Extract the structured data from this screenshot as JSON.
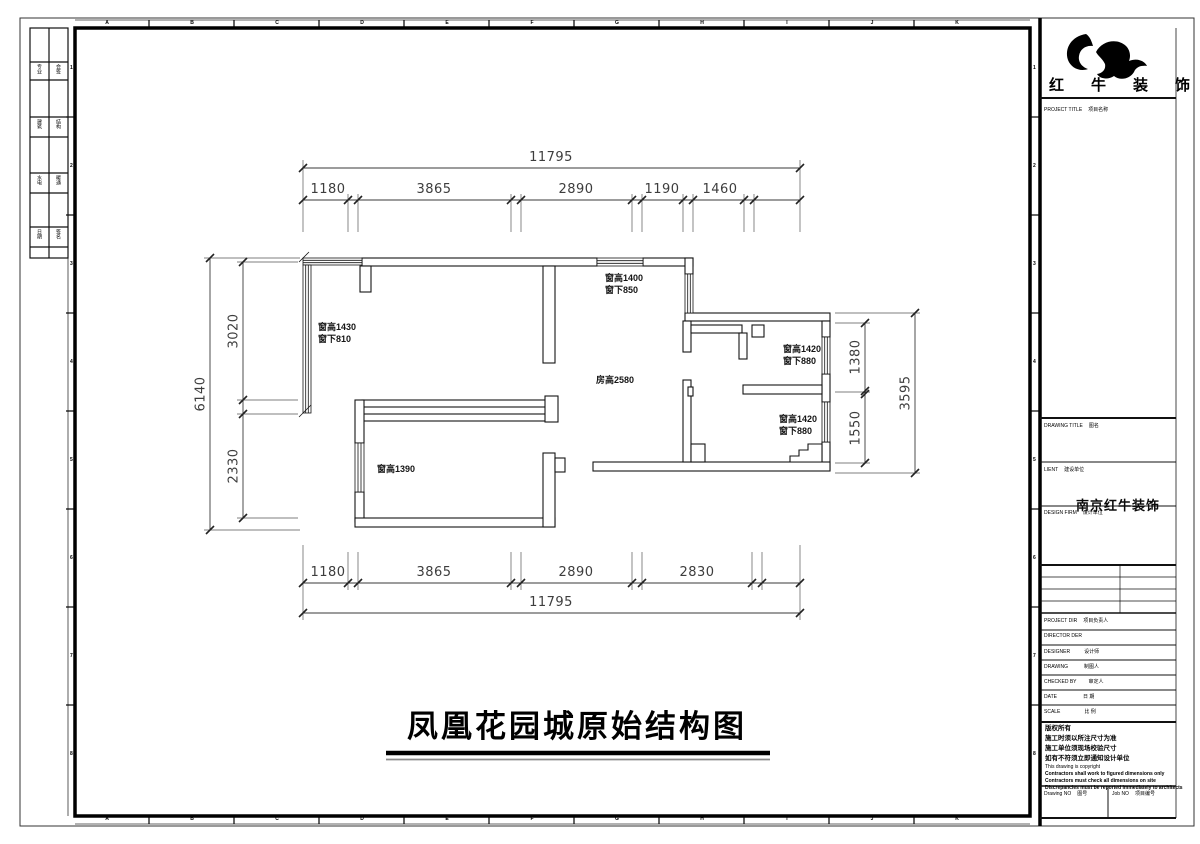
{
  "sheet": {
    "main_title": "凤凰花园城原始结构图",
    "grid_letters": [
      "A",
      "B",
      "C",
      "D",
      "E",
      "F",
      "G",
      "H",
      "I",
      "J",
      "K"
    ],
    "grid_numbers": [
      "1",
      "2",
      "3",
      "4",
      "5",
      "6",
      "7",
      "8"
    ]
  },
  "signature_bar": {
    "rows": [
      [
        "专业",
        "会签"
      ],
      [
        "建筑",
        "结构"
      ],
      [
        "水电",
        "暖通"
      ],
      [
        "日期",
        "签名"
      ]
    ]
  },
  "plan": {
    "labels": {
      "win_left_top": {
        "l1": "窗高1430",
        "l2": "窗下810"
      },
      "win_top": {
        "l1": "窗高1400",
        "l2": "窗下850"
      },
      "win_right_1": {
        "l1": "窗高1420",
        "l2": "窗下880"
      },
      "win_right_2": {
        "l1": "窗高1420",
        "l2": "窗下880"
      },
      "win_left_bottom": "窗高1390",
      "room_height": "房高2580"
    },
    "dims": {
      "top_total": "11795",
      "top_segs": [
        "1180",
        "3865",
        "2890",
        "1190",
        "1460"
      ],
      "bottom_segs": [
        "1180",
        "3865",
        "2890",
        "2830"
      ],
      "bottom_total": "11795",
      "left_total": "6140",
      "left_segs": [
        "3020",
        "2330"
      ],
      "right_segs": [
        "1380",
        "1550"
      ],
      "right_total": "3595"
    }
  },
  "tb": {
    "company": "红牛装饰",
    "project_title": {
      "en": "PROJECT TITLE",
      "zh": "项目名称"
    },
    "drawing_title": {
      "en": "DRAWING TITLE",
      "zh": "图名"
    },
    "client": {
      "en": "LIENT",
      "zh": "建设单位"
    },
    "design_firm": {
      "en": "DESIGN FIRM",
      "zh": "设计单位"
    },
    "stamp": "南京红牛装饰",
    "project_dir": {
      "en": "PROJECT DIR",
      "zh": "项目负责人"
    },
    "director": {
      "en": "DIRECTOR DER",
      "zh": ""
    },
    "designer": {
      "en": "DESIGNER",
      "zh": "设计师"
    },
    "drawing": {
      "en": "DRAWING",
      "zh": "制图人"
    },
    "checked": {
      "en": "CHECKED BY",
      "zh": "审定人"
    },
    "date": {
      "en": "DATE",
      "zh": "日 期"
    },
    "scale": {
      "en": "SCALE",
      "zh": "比 例"
    },
    "notes": [
      "版权所有",
      "施工时须以所注尺寸为准",
      "施工单位须现场校验尺寸",
      "如有不符须立即通知设计单位",
      "This drawing is copyright",
      "Contractors shall work to figured dimensions only",
      "Contractors must check all dimensions on site",
      "Discrepancies must be reported immediately to architects"
    ],
    "drawing_no": {
      "en": "Drawing NO",
      "zh": "图号"
    },
    "job_no": {
      "en": "Job NO",
      "zh": "项目编号"
    }
  }
}
